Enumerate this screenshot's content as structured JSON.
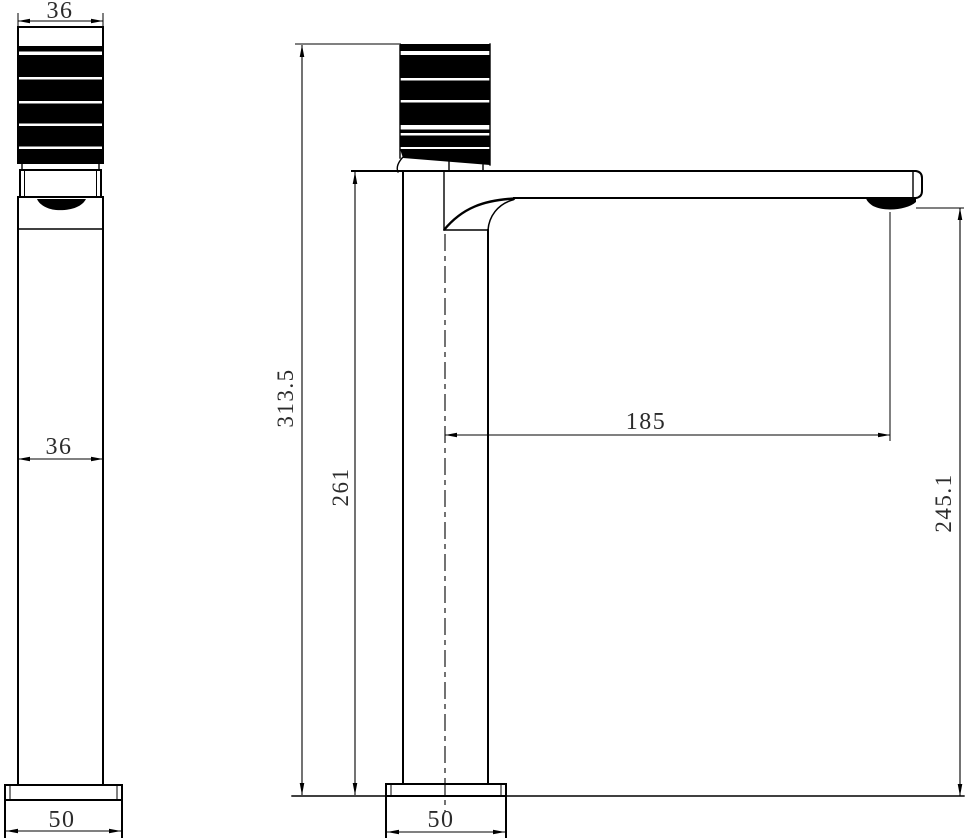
{
  "drawing": {
    "background": "#ffffff",
    "line_color": "#000000",
    "text_color": "#2b2b2b",
    "views": {
      "front": {
        "name": "front-view",
        "dimensions": {
          "handle_width": "36",
          "body_width": "36",
          "base_width": "50"
        }
      },
      "side": {
        "name": "side-view",
        "dimensions": {
          "overall_height": "313.5",
          "body_height": "261",
          "spout_reach": "185",
          "outlet_height": "245.1",
          "base_width": "50"
        }
      }
    }
  }
}
